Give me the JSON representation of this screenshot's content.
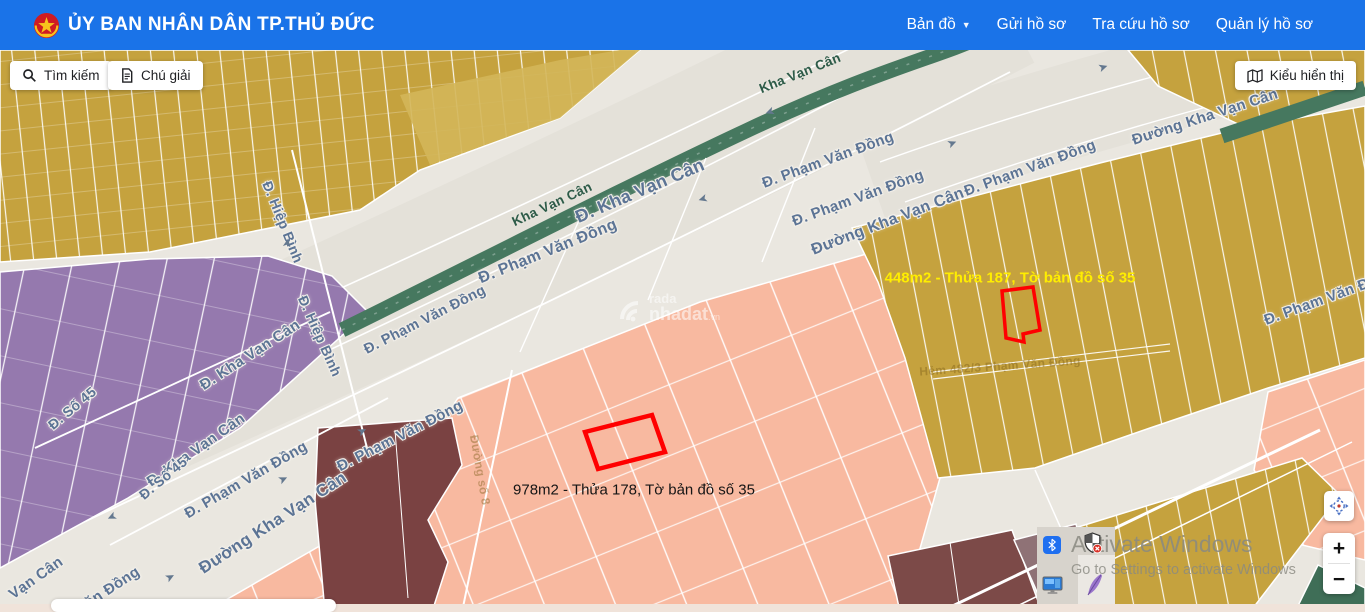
{
  "header": {
    "title": "ỦY BAN NHÂN DÂN TP.THỦ ĐỨC",
    "nav": [
      {
        "label": "Bản đồ",
        "dropdown": true
      },
      {
        "label": "Gửi hồ sơ",
        "dropdown": false
      },
      {
        "label": "Tra cứu hồ sơ",
        "dropdown": false
      },
      {
        "label": "Quản lý hồ sơ",
        "dropdown": false
      }
    ]
  },
  "toolbar": {
    "search": "Tìm kiếm",
    "legend": "Chú giải",
    "display_mode": "Kiểu hiển thị"
  },
  "map": {
    "highlighted_parcels": [
      {
        "label": "448m2 - Thửa 187, Tờ bản đồ số 35",
        "text_color": "#ffee00",
        "outline": "#ff0000"
      },
      {
        "label": "978m2 - Thửa 178, Tờ bản đồ số 35",
        "text_color": "#151515",
        "outline": "#ff0000"
      }
    ],
    "street_labels": [
      {
        "text": "Đ. Kha Vạn Cân",
        "x": 640,
        "y": 191,
        "rot": -23,
        "size": 18,
        "kind": "road"
      },
      {
        "text": "Kha Vạn Cân",
        "x": 552,
        "y": 204,
        "rot": -25,
        "size": 13.5,
        "kind": "rail"
      },
      {
        "text": "Kha Vạn Cân",
        "x": 800,
        "y": 73,
        "rot": -22,
        "size": 13.5,
        "kind": "rail"
      },
      {
        "text": "Đ. Phạm Văn Đồng",
        "x": 828,
        "y": 160,
        "rot": -20,
        "size": 15,
        "kind": "road"
      },
      {
        "text": "Đ. Phạm Văn Đồng",
        "x": 858,
        "y": 198,
        "rot": -20,
        "size": 15,
        "kind": "road"
      },
      {
        "text": "Đường Kha Vạn Cân",
        "x": 888,
        "y": 222,
        "rot": -21,
        "size": 16,
        "kind": "road"
      },
      {
        "text": "Đ. Phạm Văn Đồng",
        "x": 1030,
        "y": 168,
        "rot": -20,
        "size": 15,
        "kind": "road"
      },
      {
        "text": "Đường Kha Vạn Cân",
        "x": 1205,
        "y": 117,
        "rot": -18,
        "size": 15,
        "kind": "road"
      },
      {
        "text": "Đ. Phạm Văn Đồng",
        "x": 1330,
        "y": 297,
        "rot": -20,
        "size": 15,
        "kind": "road"
      },
      {
        "text": "Đ. Phạm Văn Đồng",
        "x": 548,
        "y": 252,
        "rot": -22,
        "size": 16,
        "kind": "road"
      },
      {
        "text": "Đ. Phạm Văn Đồng",
        "x": 425,
        "y": 320,
        "rot": -27,
        "size": 14.5,
        "kind": "road"
      },
      {
        "text": "Đ. Kha Vạn Cân",
        "x": 250,
        "y": 355,
        "rot": -33,
        "size": 15,
        "kind": "road"
      },
      {
        "text": "Đ. Kha Vạn Cân",
        "x": 196,
        "y": 450,
        "rot": -35,
        "size": 15,
        "kind": "road"
      },
      {
        "text": "Đ. Hiệp Bình",
        "x": 283,
        "y": 222,
        "rot": 68,
        "size": 14,
        "kind": "road"
      },
      {
        "text": "Đ. Hiệp Bình",
        "x": 320,
        "y": 336,
        "rot": 66,
        "size": 14,
        "kind": "road"
      },
      {
        "text": "Đ. Số 45",
        "x": 72,
        "y": 408,
        "rot": -40,
        "size": 14,
        "kind": "road"
      },
      {
        "text": "Đ. Số 45",
        "x": 163,
        "y": 478,
        "rot": -40,
        "size": 14,
        "kind": "road"
      },
      {
        "text": "Đ. Phạm Văn Đồng",
        "x": 246,
        "y": 480,
        "rot": -30,
        "size": 15,
        "kind": "road"
      },
      {
        "text": "Đường Kha Vạn Cân",
        "x": 273,
        "y": 523,
        "rot": -33,
        "size": 17,
        "kind": "road"
      },
      {
        "text": "Đ. Phạm Văn Đồng",
        "x": 400,
        "y": 436,
        "rot": -27,
        "size": 15,
        "kind": "road"
      },
      {
        "text": "Vạn Cân",
        "x": 36,
        "y": 578,
        "rot": -35,
        "size": 15,
        "kind": "road"
      },
      {
        "text": "Văn Đồng",
        "x": 108,
        "y": 590,
        "rot": -33,
        "size": 15,
        "kind": "road"
      },
      {
        "text": "Hẻm 482/3 Phạm Văn Đồng",
        "x": 1000,
        "y": 366,
        "rot": -4,
        "size": 12,
        "kind": "alley"
      },
      {
        "text": "Đường số 8",
        "x": 480,
        "y": 470,
        "rot": 80,
        "size": 12,
        "kind": "alley"
      }
    ],
    "arrows": [
      {
        "x": 703,
        "y": 199,
        "r": 163
      },
      {
        "x": 770,
        "y": 112,
        "r": 160
      },
      {
        "x": 952,
        "y": 143,
        "r": -22
      },
      {
        "x": 1103,
        "y": 67,
        "r": -18
      },
      {
        "x": 362,
        "y": 431,
        "r": -28
      },
      {
        "x": 283,
        "y": 479,
        "r": -25
      },
      {
        "x": 170,
        "y": 577,
        "r": -28
      },
      {
        "x": 112,
        "y": 517,
        "r": 155
      },
      {
        "x": 287,
        "y": 243,
        "r": -80
      }
    ],
    "map_watermark": {
      "top": "rada",
      "brand": "nhadat",
      "suffix": ".vn"
    },
    "controls": {
      "zoom_in": "+",
      "zoom_out": "−"
    },
    "colors": {
      "header_blue": "#1a73e8",
      "base": "#eae7e0",
      "road": "#e4e1d9",
      "gold": "#c5a23e",
      "gold_light": "#d3b659",
      "purple": "#9579ae",
      "salmon": "#f8b9a0",
      "maroon_dark": "#7a4242",
      "maroon": "#7c4a48",
      "mauve": "#8f7276",
      "rail_green": "#46785f",
      "parcel_outline": "#ff0000",
      "street_label": "#5c7495"
    }
  },
  "os_watermark": {
    "line1": "Activate Windows",
    "line2": "Go to Settings to activate Windows"
  },
  "tray_icons": [
    "bluetooth",
    "security-shield",
    "remote-desktop",
    "feather-pen"
  ]
}
